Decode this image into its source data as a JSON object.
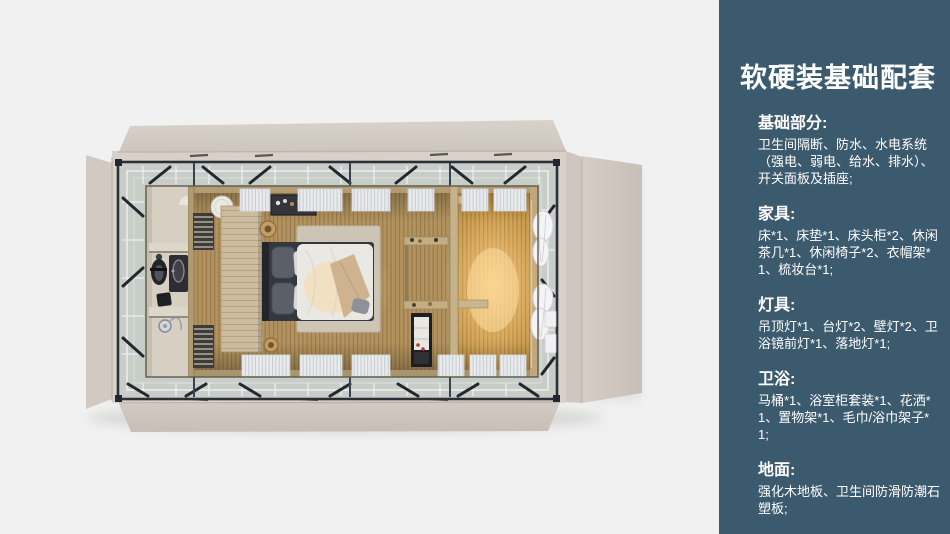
{
  "panel": {
    "background": "#3c5a6d",
    "text_color": "#ffffff",
    "title": "软硬装基础配套",
    "sections": [
      {
        "heading": "基础部分:",
        "body": "卫生间隔断、防水、水电系统（强电、弱电、给水、排水）、开关面板及插座;"
      },
      {
        "heading": "家具:",
        "body": "床*1、床垫*1、床头柜*2、休闲茶几*1、休闲椅子*2、衣帽架*1、梳妆台*1;"
      },
      {
        "heading": "灯具:",
        "body": "吊顶灯*1、台灯*2、壁灯*2、卫浴镜前灯*1、落地灯*1;"
      },
      {
        "heading": "卫浴:",
        "body": "马桶*1、浴室柜套装*1、花洒*1、置物架*1、毛巾/浴巾架子*1;"
      },
      {
        "heading": "地面:",
        "body": "强化木地板、卫生间防滑防潮石塑板;"
      }
    ]
  },
  "floorplan": {
    "palette": {
      "background": "#f1f1f2",
      "shell_beige": "#d7d0c8",
      "steel_frame": "#2a2f3a",
      "glass_band": "#c7cdc7",
      "wood_floor": "#b2935f",
      "warm_glow": "#ffcf85",
      "bathroom_tile": "#d7d0c2",
      "duvet_white": "#eae8e3"
    }
  }
}
